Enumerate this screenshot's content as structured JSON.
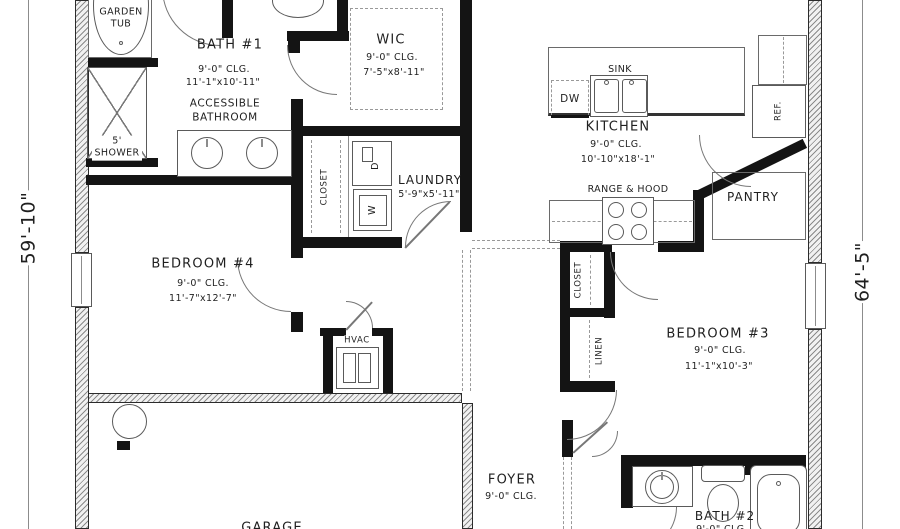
{
  "dimension_left": "59'-10\"",
  "dimension_right": "64'-5\"",
  "rooms": {
    "bath1": {
      "name": "BATH #1",
      "ceiling": "9'-0\" CLG.",
      "size": "11'-1\"x10'-11\"",
      "note": "ACCESSIBLE BATHROOM"
    },
    "garden_tub": "GARDEN TUB",
    "shower": "5' SHOWER",
    "wic": {
      "name": "WIC",
      "ceiling": "9'-0\" CLG.",
      "size": "7'-5\"x8'-11\""
    },
    "hall_closet": "CLOSET",
    "laundry": {
      "name": "LAUNDRY",
      "size": "5'-9\"x5'-11\"",
      "dryer": "D",
      "washer": "W"
    },
    "kitchen": {
      "name": "KITCHEN",
      "ceiling": "9'-0\" CLG.",
      "size": "10'-10\"x18'-1\"",
      "sink": "SINK",
      "dishwasher": "DW",
      "range": "RANGE & HOOD",
      "refrigerator": "REF."
    },
    "pantry": "PANTRY",
    "bedroom4": {
      "name": "BEDROOM #4",
      "ceiling": "9'-0\" CLG.",
      "size": "11'-7\"x12'-7\""
    },
    "hvac": "HVAC",
    "bedroom3": {
      "name": "BEDROOM #3",
      "ceiling": "9'-0\" CLG.",
      "size": "11'-1\"x10'-3\"",
      "closet": "CLOSET",
      "linen": "LINEN"
    },
    "foyer": {
      "name": "FOYER",
      "ceiling": "9'-0\" CLG."
    },
    "bath2": {
      "name": "BATH #2",
      "ceiling": "9'-0\" CLG."
    },
    "garage": "GARAGE"
  }
}
